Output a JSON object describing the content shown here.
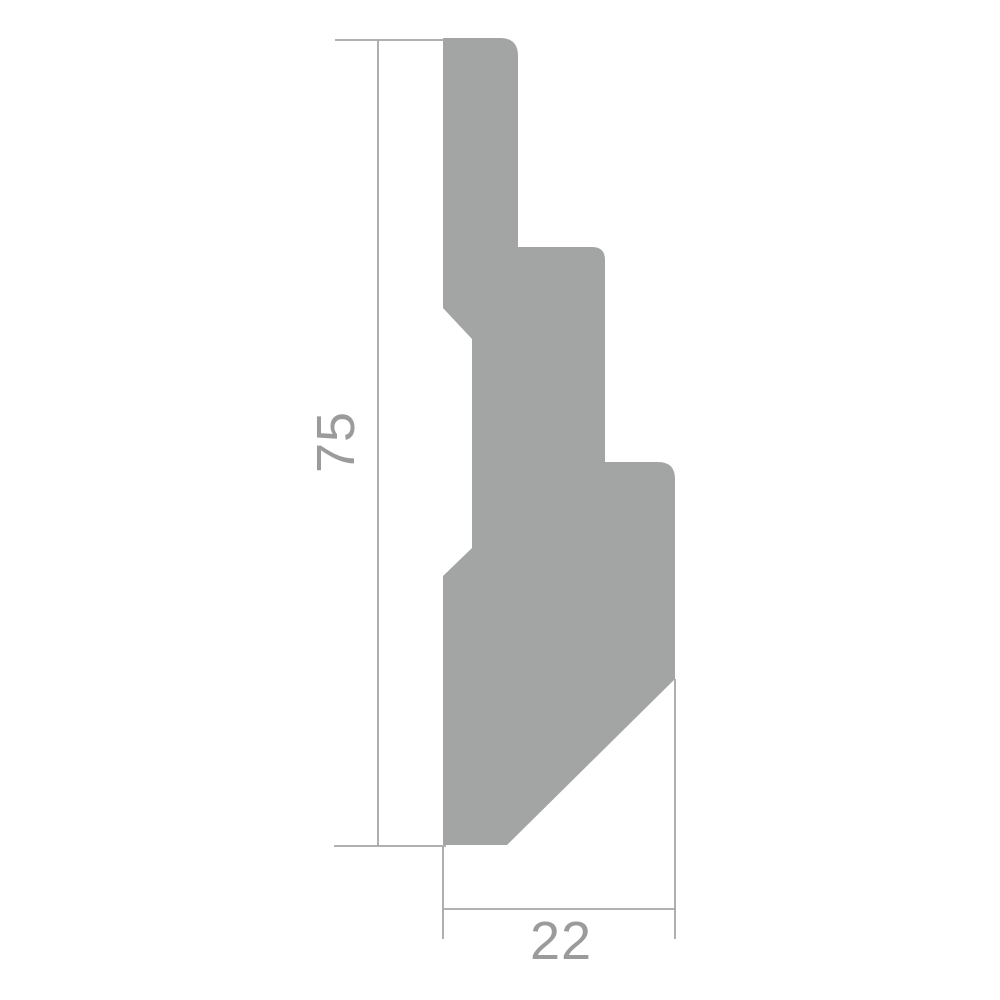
{
  "diagram": {
    "type": "technical-profile-drawing",
    "subject": "moulding-profile-cross-section",
    "dimensions": {
      "height_label": "75",
      "width_label": "22"
    },
    "colors": {
      "profile_fill": "#a2a5a3",
      "dimension_line": "#a6a6a6",
      "dimension_text": "#9b9b9b",
      "background": "#ffffff"
    },
    "profile": {
      "path_d": "M 443,38 L 500,38 Q 518,38 518,56 L 518,247 L 592,247 Q 605,247 605,260 L 605,462 L 658,462 Q 675,462 675,479 L 675,679 L 507,845 L 443,845 L 443,576 L 472,548 L 472,339 L 443,308 Z"
    },
    "dimension_lines": {
      "top_extension_d": "M 335,40 L 445,40",
      "height_dim_d": "M 378,40 L 378,846",
      "bottom_extension_d": "M 334,846 L 446,846",
      "width_left_extension_d": "M 443,846 L 443,939",
      "width_right_extension_d": "M 675,679 L 675,939",
      "width_dim_d": "M 443,909 L 675,909"
    }
  }
}
